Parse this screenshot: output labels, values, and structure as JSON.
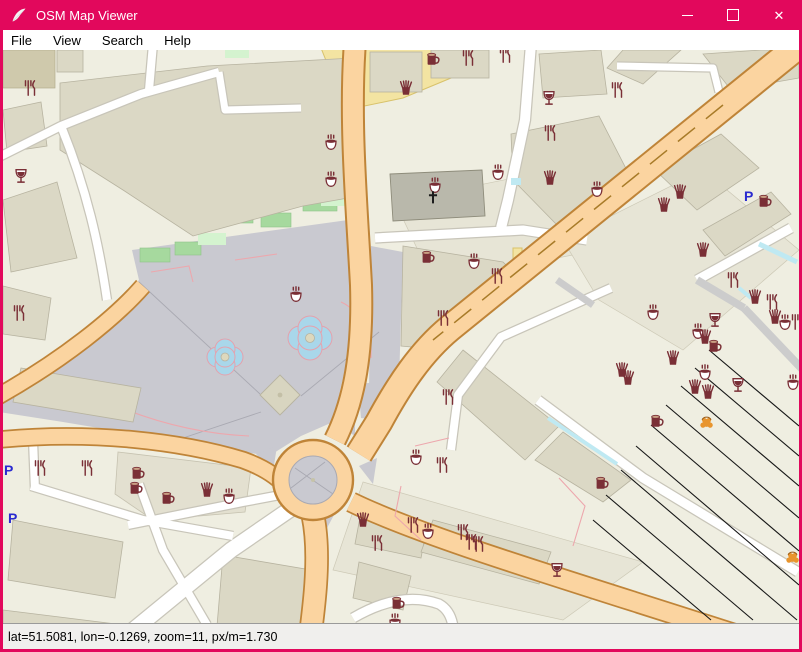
{
  "window": {
    "title": "OSM Map Viewer",
    "app_icon": "feather-icon",
    "controls": [
      "minimize",
      "maximize",
      "close"
    ],
    "close_glyph": "✕"
  },
  "menu": {
    "items": [
      "File",
      "View",
      "Search",
      "Help"
    ]
  },
  "status": {
    "text": "lat=51.5081, lon=-0.1269, zoom=11, px/m=1.730"
  },
  "theme": {
    "accent": "#e2085c",
    "poi": "#7a2f36",
    "poi-orange": "#e8952e",
    "parking": "#2a2ad0",
    "road-orange": "#fbd4a0",
    "road-casing": "#bf8438",
    "water": "#bfe9f2",
    "plaza": "#c9c9d0",
    "land": "#efeee1",
    "building": "#dbd8c5"
  },
  "map": {
    "parking_label": "P",
    "pois": [
      {
        "t": "restaurant",
        "x": 27,
        "y": 38
      },
      {
        "t": "restaurant",
        "x": 465,
        "y": 8
      },
      {
        "t": "restaurant",
        "x": 502,
        "y": 5
      },
      {
        "t": "restaurant",
        "x": 547,
        "y": 83
      },
      {
        "t": "restaurant",
        "x": 614,
        "y": 40
      },
      {
        "t": "restaurant",
        "x": 16,
        "y": 263
      },
      {
        "t": "restaurant",
        "x": 730,
        "y": 230
      },
      {
        "t": "restaurant",
        "x": 769,
        "y": 252
      },
      {
        "t": "restaurant",
        "x": 794,
        "y": 272
      },
      {
        "t": "restaurant",
        "x": 37,
        "y": 418
      },
      {
        "t": "restaurant",
        "x": 84,
        "y": 418
      },
      {
        "t": "restaurant",
        "x": 445,
        "y": 347
      },
      {
        "t": "restaurant",
        "x": 439,
        "y": 415
      },
      {
        "t": "restaurant",
        "x": 410,
        "y": 475
      },
      {
        "t": "restaurant",
        "x": 374,
        "y": 493
      },
      {
        "t": "restaurant",
        "x": 460,
        "y": 482
      },
      {
        "t": "restaurant",
        "x": 468,
        "y": 492
      },
      {
        "t": "restaurant",
        "x": 475,
        "y": 494
      },
      {
        "t": "restaurant",
        "x": 494,
        "y": 226
      },
      {
        "t": "restaurant",
        "x": 440,
        "y": 268
      },
      {
        "t": "cafe",
        "x": 328,
        "y": 93
      },
      {
        "t": "cafe",
        "x": 328,
        "y": 130
      },
      {
        "t": "cafe",
        "x": 432,
        "y": 136
      },
      {
        "t": "cafe",
        "x": 495,
        "y": 123
      },
      {
        "t": "cafe",
        "x": 594,
        "y": 140
      },
      {
        "t": "cafe",
        "x": 293,
        "y": 245
      },
      {
        "t": "cafe",
        "x": 650,
        "y": 263
      },
      {
        "t": "cafe",
        "x": 695,
        "y": 282
      },
      {
        "t": "cafe",
        "x": 782,
        "y": 273
      },
      {
        "t": "cafe",
        "x": 702,
        "y": 323
      },
      {
        "t": "cafe",
        "x": 790,
        "y": 333
      },
      {
        "t": "cafe",
        "x": 413,
        "y": 408
      },
      {
        "t": "cafe",
        "x": 425,
        "y": 482
      },
      {
        "t": "cafe",
        "x": 226,
        "y": 447
      },
      {
        "t": "cafe",
        "x": 392,
        "y": 572
      },
      {
        "t": "cafe",
        "x": 471,
        "y": 212
      },
      {
        "t": "bar",
        "x": 18,
        "y": 126
      },
      {
        "t": "bar",
        "x": 546,
        "y": 48
      },
      {
        "t": "bar",
        "x": 712,
        "y": 270
      },
      {
        "t": "bar",
        "x": 735,
        "y": 335
      },
      {
        "t": "bar",
        "x": 554,
        "y": 520
      },
      {
        "t": "pub",
        "x": 430,
        "y": 8
      },
      {
        "t": "pub",
        "x": 762,
        "y": 150
      },
      {
        "t": "pub",
        "x": 712,
        "y": 295
      },
      {
        "t": "pub",
        "x": 654,
        "y": 370
      },
      {
        "t": "pub",
        "x": 599,
        "y": 432
      },
      {
        "t": "pub",
        "x": 135,
        "y": 422
      },
      {
        "t": "pub",
        "x": 133,
        "y": 437
      },
      {
        "t": "pub",
        "x": 165,
        "y": 447
      },
      {
        "t": "pub",
        "x": 395,
        "y": 552
      },
      {
        "t": "pub",
        "x": 425,
        "y": 206
      },
      {
        "t": "fastfood",
        "x": 403,
        "y": 38
      },
      {
        "t": "fastfood",
        "x": 547,
        "y": 128
      },
      {
        "t": "fastfood",
        "x": 677,
        "y": 142
      },
      {
        "t": "fastfood",
        "x": 661,
        "y": 155
      },
      {
        "t": "fastfood",
        "x": 700,
        "y": 200
      },
      {
        "t": "fastfood",
        "x": 752,
        "y": 247
      },
      {
        "t": "fastfood",
        "x": 772,
        "y": 267
      },
      {
        "t": "fastfood",
        "x": 702,
        "y": 287
      },
      {
        "t": "fastfood",
        "x": 670,
        "y": 308
      },
      {
        "t": "fastfood",
        "x": 619,
        "y": 320
      },
      {
        "t": "fastfood",
        "x": 625,
        "y": 328
      },
      {
        "t": "fastfood",
        "x": 692,
        "y": 337
      },
      {
        "t": "fastfood",
        "x": 705,
        "y": 342
      },
      {
        "t": "fastfood",
        "x": 204,
        "y": 440
      },
      {
        "t": "fastfood",
        "x": 360,
        "y": 470
      },
      {
        "t": "church",
        "x": 430,
        "y": 148
      },
      {
        "t": "parking",
        "x": 741,
        "y": 146
      },
      {
        "t": "parking",
        "x": 5,
        "y": 468
      },
      {
        "t": "parking",
        "x": 1,
        "y": 420
      },
      {
        "t": "marketplace",
        "x": 704,
        "y": 372
      },
      {
        "t": "marketplace",
        "x": 790,
        "y": 507
      }
    ]
  }
}
